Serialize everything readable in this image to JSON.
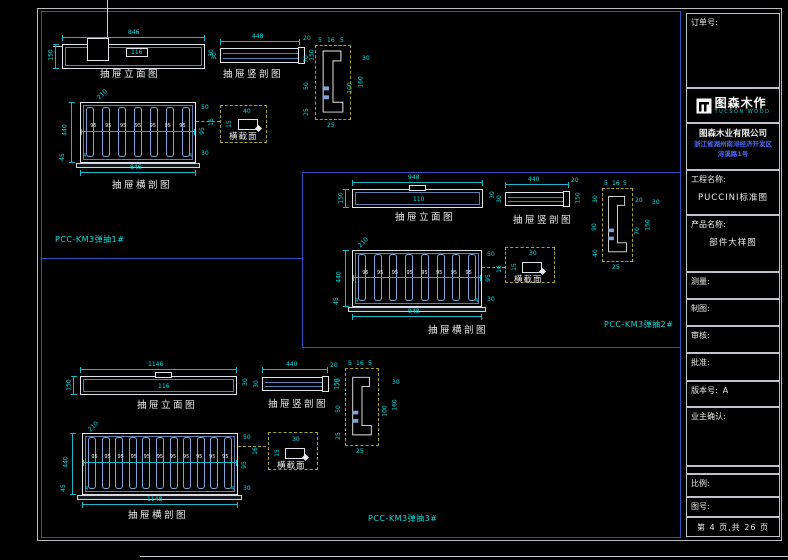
{
  "title_block": {
    "order_label": "订单号:",
    "logo_name": "图森木作",
    "logo_sub": "TUCSON WOOD",
    "company": "图森木业有限公司",
    "address_line1": "浙江省湖州南浔经济开发区",
    "address_line2": "浔溪路1号",
    "project_label": "工程名称:",
    "project_value": "PUCCINI标准图",
    "product_label": "产品名称:",
    "product_value": "部件大样图",
    "measure_label": "测量:",
    "draft_label": "制图:",
    "audit_label": "审核:",
    "approve_label": "批准:",
    "version_label": "版本号:",
    "version_value": "A",
    "owner_label": "业主确认:",
    "scale_label": "比例:",
    "figure_label": "图号:",
    "page_text": "第 4 页,共 26 页"
  },
  "groups": [
    {
      "code": "PCC-KM3弹抽1#",
      "elev": {
        "label": "抽屉立面图",
        "w": "846",
        "h": "150",
        "inner": "116",
        "side": "30"
      },
      "vsec": {
        "label": "抽屉竖剖图",
        "w": "448",
        "left": "30",
        "cap_top": "20",
        "cap_right": "150"
      },
      "hsec": {
        "label": "抽屉横剖图",
        "w": "846",
        "h": "440",
        "diag": "210",
        "bl": "45",
        "r1": "50",
        "r2": "95",
        "r3": "30",
        "wall": "4",
        "cell": "95",
        "lead": "16",
        "slots": 7
      },
      "cross": {
        "label": "横截面",
        "w": "40",
        "h": "15"
      },
      "prof": {
        "top": [
          "5",
          "16",
          "5"
        ],
        "left": [
          "70",
          "50",
          "25"
        ],
        "right": [
          "30",
          "100",
          "160"
        ],
        "bottom": "25"
      }
    },
    {
      "code": "PCC-KM3弹抽2#",
      "elev": {
        "label": "抽屉立面图",
        "w": "948",
        "h": "150",
        "inner": "110",
        "side": "30"
      },
      "vsec": {
        "label": "抽屉竖剖图",
        "w": "440",
        "left": "30",
        "cap_top": "20",
        "cap_right": "150"
      },
      "hsec": {
        "label": "抽屉横剖图",
        "w": "948",
        "h": "440",
        "diag": "210",
        "bl": "45",
        "r1": "50",
        "r2": "95",
        "r3": "30",
        "wall": "4",
        "cell": "95",
        "lead": "16",
        "slots": 8
      },
      "cross": {
        "label": "横截面",
        "w": "30",
        "h": "15"
      },
      "prof": {
        "top": [
          "5",
          "16",
          "5"
        ],
        "left": [
          "30",
          "90",
          "40"
        ],
        "right": [
          "20",
          "70",
          "150"
        ],
        "bottom": "25"
      }
    },
    {
      "code": "PCC-KM3弹抽3#",
      "elev": {
        "label": "抽屉立面图",
        "w": "1146",
        "h": "150",
        "inner": "116",
        "side": "30"
      },
      "vsec": {
        "label": "抽屉竖剖图",
        "w": "440",
        "left": "30",
        "cap_top": "20",
        "cap_right": "150"
      },
      "hsec": {
        "label": "抽屉横剖图",
        "w": "1148",
        "h": "440",
        "diag": "210",
        "bl": "45",
        "r1": "50",
        "r2": "95",
        "r3": "30",
        "wall": "4",
        "cell": "95",
        "lead": "16",
        "slots": 11
      },
      "cross": {
        "label": "横截面",
        "w": "30",
        "h": "15"
      },
      "prof": {
        "top": [
          "5",
          "16",
          "5"
        ],
        "left": [
          "70",
          "50",
          "25"
        ],
        "right": [
          "30",
          "100",
          "160"
        ],
        "bottom": "25"
      }
    }
  ]
}
